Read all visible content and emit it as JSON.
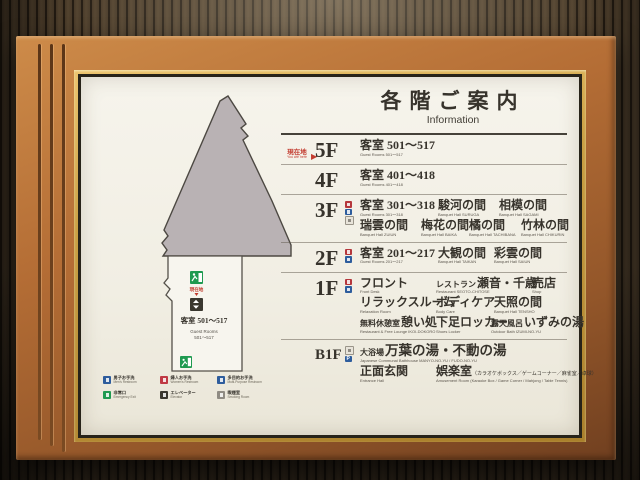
{
  "sign": {
    "title_jp": "各階ご案内",
    "title_en": "Information",
    "you_are_here": {
      "jp": "現在地",
      "en": "You are here"
    },
    "map": {
      "room_block": {
        "jp": "客室 501〜517",
        "en_line1": "Guest Rooms",
        "en_line2": "501〜517"
      },
      "marker_jp": "現在地",
      "legend": [
        {
          "jp": "男子お手洗",
          "en": "Men's Restroom",
          "icon": "mens-restroom",
          "color": "#2e5d9d"
        },
        {
          "jp": "婦人お手洗",
          "en": "Women's Restroom",
          "icon": "womens-restroom",
          "color": "#c03a44"
        },
        {
          "jp": "多目的お手洗",
          "en": "Multi-Purpose Restroom",
          "icon": "accessible-restroom",
          "color": "#2e5d9d"
        },
        {
          "jp": "非常口",
          "en": "Emergency Exit",
          "icon": "emergency-exit",
          "color": "#1f9a50"
        },
        {
          "jp": "エレベーター",
          "en": "Elevator",
          "icon": "elevator",
          "color": "#3a372f"
        },
        {
          "jp": "喫煙室",
          "en": "Smoking Room",
          "icon": "smoking-room",
          "color": "#8f8b83"
        }
      ]
    },
    "floors": [
      {
        "label": "5F",
        "icons": [],
        "lines": [
          [
            {
              "jp": "客室 501〜517",
              "en": "Guest Rooms 501〜517"
            }
          ]
        ]
      },
      {
        "label": "4F",
        "icons": [],
        "lines": [
          [
            {
              "jp": "客室 401〜418",
              "en": "Guest Rooms 401〜418"
            }
          ]
        ]
      },
      {
        "label": "3F",
        "icons": [
          "escalator",
          "elevator",
          "vending-machine"
        ],
        "lines": [
          [
            {
              "jp": "客室 301〜318",
              "en": "Guest Rooms 301〜318"
            },
            {
              "jp": "駿河の間",
              "en": "Banquet Hall SURUGA"
            },
            {
              "jp": "相模の間",
              "en": "Banquet Hall SAGAMI"
            }
          ],
          [
            {
              "jp": "瑞雲の間",
              "en": "Banquet Hall ZUIUN"
            },
            {
              "jp": "梅花の間",
              "en": "Banquet Hall BAIKA"
            },
            {
              "jp": "橘の間",
              "en": "Banquet Hall TACHIBANA"
            },
            {
              "jp": "竹林の間",
              "en": "Banquet Hall CHIKURIN"
            }
          ]
        ]
      },
      {
        "label": "2F",
        "icons": [
          "escalator",
          "elevator"
        ],
        "lines": [
          [
            {
              "jp": "客室 201〜217",
              "en": "Guest Rooms 201〜217"
            },
            {
              "jp": "大観の間",
              "en": "Banquet Hall TAIKAN"
            },
            {
              "jp": "彩雲の間",
              "en": "Banquet Hall SAIUN"
            }
          ]
        ]
      },
      {
        "label": "1F",
        "icons": [
          "escalator",
          "elevator"
        ],
        "lines": [
          [
            {
              "jp": "フロント",
              "en": "Front Desk"
            },
            {
              "jp_prefix": "レストラン",
              "jp": "瀬音・千歳",
              "en": "Restaurant SEOTO-CHITOSE"
            },
            {
              "jp": "売店",
              "en": "Shop"
            }
          ],
          [
            {
              "jp": "リラックスルーム",
              "en": "Relaxation Room"
            },
            {
              "jp": "ボディケア",
              "en": "Body Care"
            },
            {
              "jp": "天照の間",
              "en": "Banquet Hall TENSHO"
            }
          ],
          [
            {
              "jp_prefix": "無料休憩室",
              "jp": "憩い処",
              "en": "Restaurant & Free Lounge IKOI-DOKORO"
            },
            {
              "jp": "下足ロッカー",
              "en": "Shoes Locker"
            },
            {
              "jp_prefix": "露天風呂",
              "jp": "いずみの湯",
              "en": "Outdoor Bath IZUMI-NO-YU"
            }
          ]
        ]
      },
      {
        "label": "B1F",
        "icons": [
          "smoking-room",
          "parking"
        ],
        "lines": [
          [
            {
              "jp_prefix": "大浴場",
              "jp": "万葉の湯・不動の湯",
              "en": "Japanese Communal Bathhouse MANYO-NO-YU / FUDO-NO-YU"
            }
          ],
          [
            {
              "jp": "正面玄関",
              "en": "Entrance Hall"
            },
            {
              "jp": "娯楽室",
              "jp_note": "（カラオケボックス／ゲームコーナー／麻雀室／卓球）",
              "en": "Amusement Room (Karaoke Box / Game Corner / Mahjong / Table Tennis)"
            }
          ]
        ]
      }
    ],
    "colors": {
      "frame_copper": "#b46d35",
      "gold_trim": "#caa044",
      "sign_face": "#f2efe6",
      "accent_red": "#c23b2e",
      "icon_blue": "#2e5d9d",
      "icon_red": "#b5373c",
      "icon_green": "#1f9a50",
      "map_gray": "#b9b2b4"
    }
  }
}
